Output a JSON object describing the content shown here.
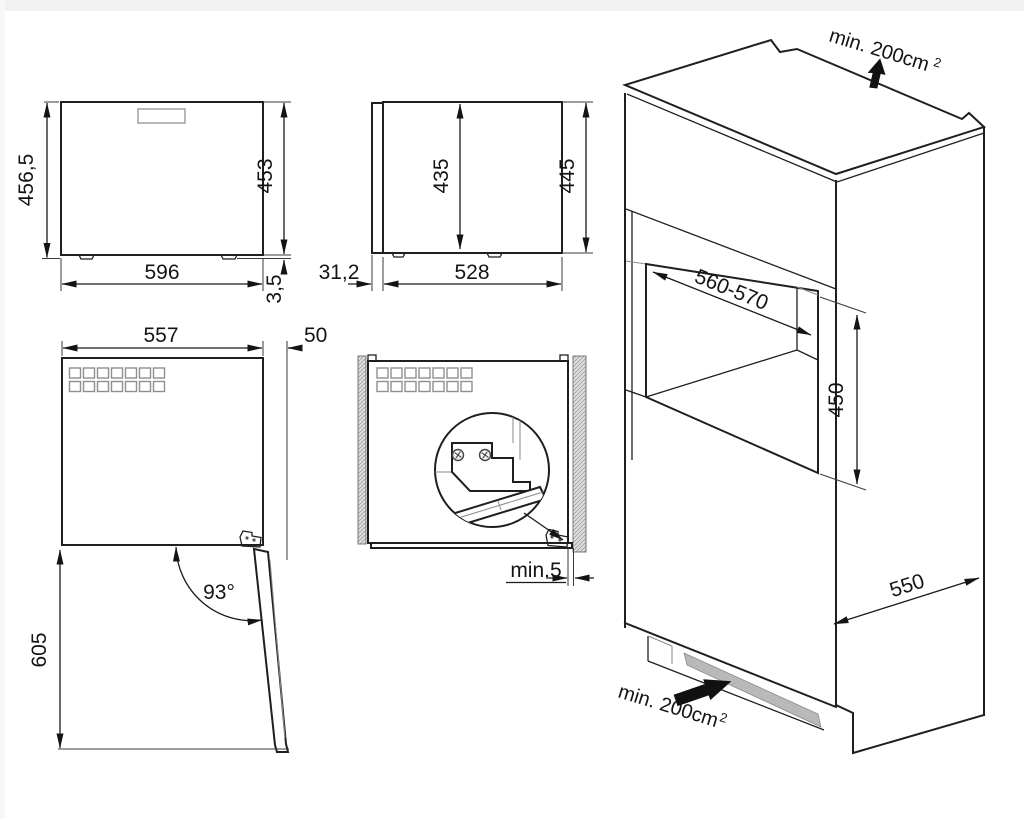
{
  "diagram_title": "built-in appliance installation drawing",
  "colors": {
    "line": "#1f1f1f",
    "vent_strip": "#b9b9b9",
    "wall_hatch": "#e8e8e8",
    "arrow_fill": "#111111"
  },
  "views": {
    "front": {
      "dim_total_height": "456,5",
      "dim_body_height": "453",
      "dim_width": "596",
      "dim_foot_height": "3,5"
    },
    "side": {
      "dim_inner_height": "435",
      "dim_total_height": "445",
      "dim_door_thickness": "31,2",
      "dim_depth": "528"
    },
    "top_open": {
      "dim_width": "557",
      "dim_front_clearance": "50",
      "dim_door_angle": "93°",
      "dim_open_depth": "605"
    },
    "installed": {
      "dim_side_gap": "min.5"
    },
    "cabinet": {
      "vent_top_label": "min. 200cm",
      "vent_top_sup": "2",
      "dim_niche_width": "560-570",
      "dim_niche_height": "450",
      "dim_cabinet_depth": "550",
      "vent_bottom_label": "min. 200cm",
      "vent_bottom_sup": "2"
    }
  },
  "vent_grids": {
    "cols": 7,
    "rows": 2
  }
}
